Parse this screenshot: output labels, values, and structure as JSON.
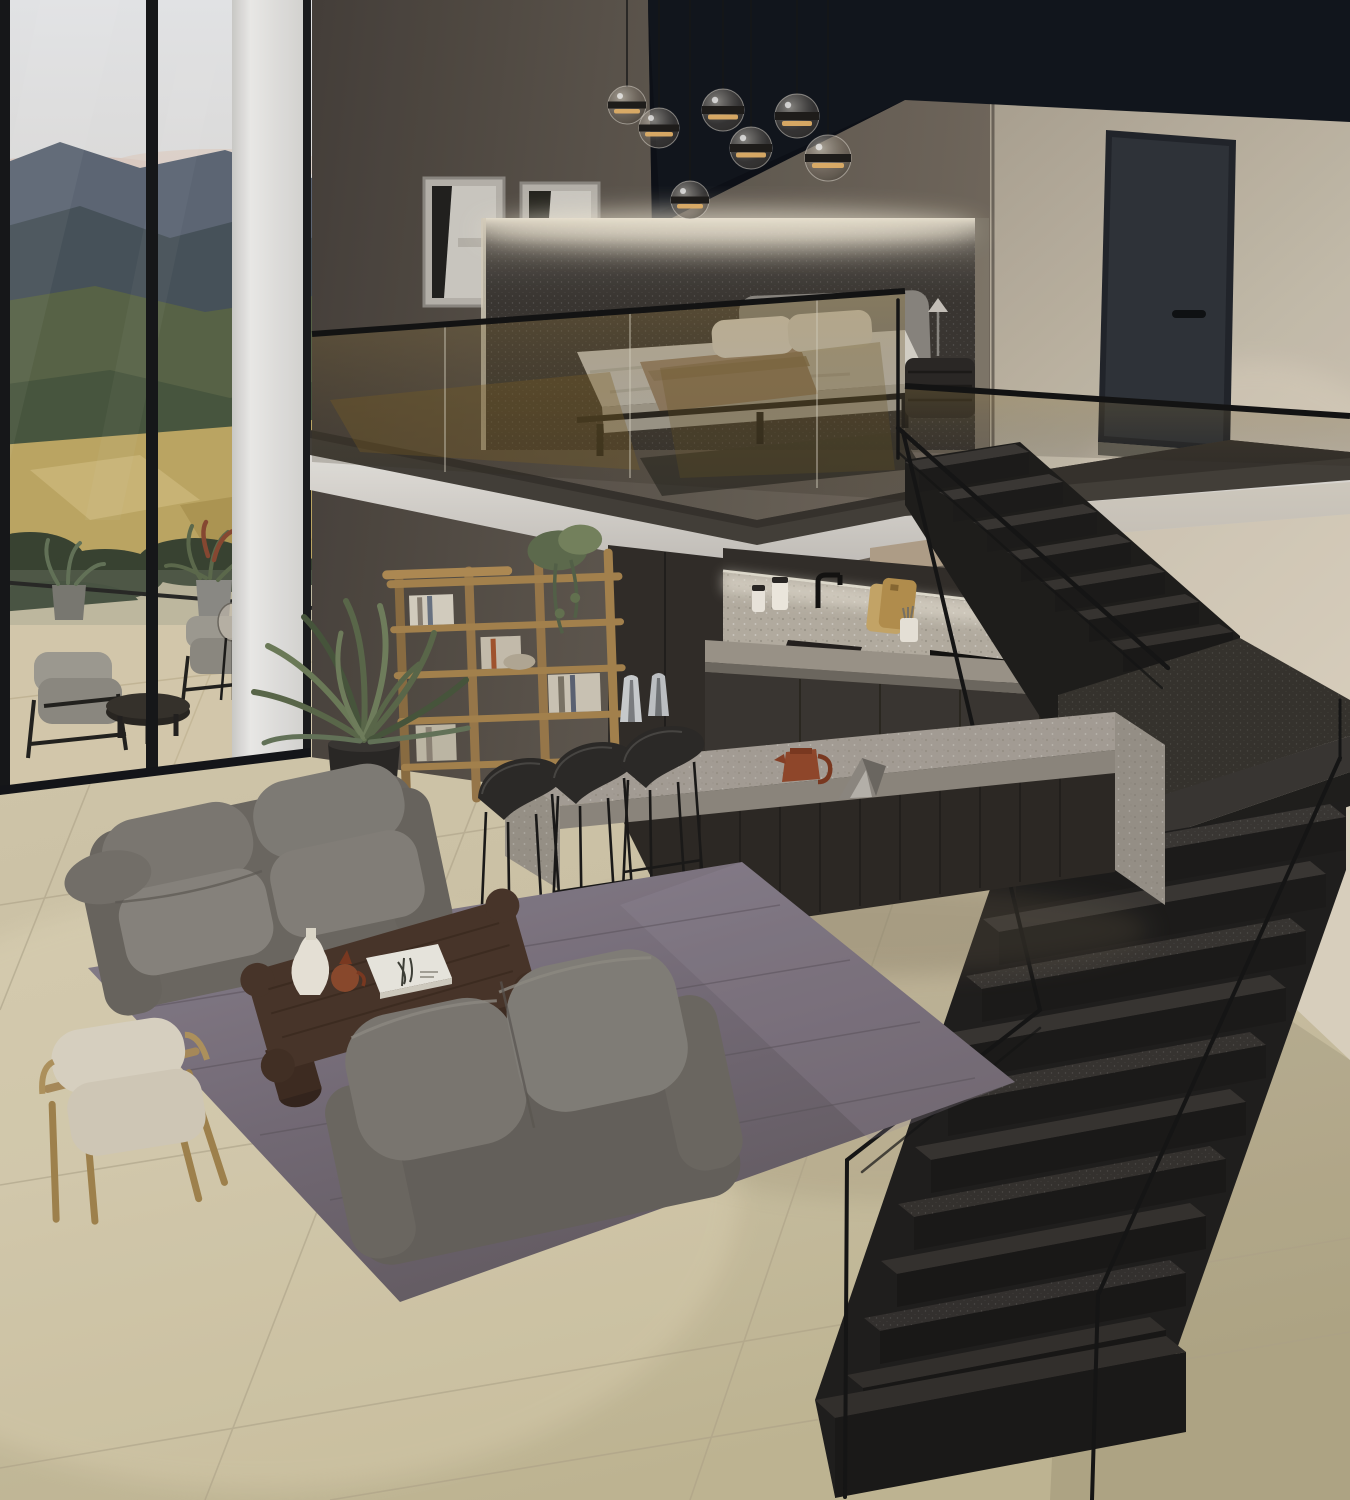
{
  "scene": {
    "title": "Double-height modern loft interior with mezzanine bedroom, open kitchen, lounge and black stone staircase overlooking mountains",
    "render_style": "photorealistic 3D architectural visualization",
    "setting": "daytime, mountain valley view through floor-to-ceiling glazing"
  },
  "palette": {
    "sky": "#e0e1e3",
    "mountains_far": "#5f6977",
    "hills_green": "#55604a",
    "fields_gold": "#c0aa66",
    "wall_taupe": "#57504a",
    "wall_cream": "#c7beac",
    "ceiling_recess_black": "#12161d",
    "slab_edge_white": "#dbd8d3",
    "stair_stone_black": "#2e2c29",
    "kitchen_cabinet_dark": "#37322e",
    "backsplash_terrazzo": "#b7b0a4",
    "island_terrazzo": "#a49d93",
    "floor_tile_beige": "#cfc5a8",
    "rug_grey_mauve": "#7c7380",
    "sofa_grey": "#75716b",
    "coffee_table_wood": "#4a362b",
    "accent_chair_cream": "#dcd4c2",
    "accent_chair_oak": "#ab8d5c",
    "bookshelf_oak": "#9b7a4c",
    "plant_green": "#5e6c4e",
    "bed_linen": "#d8d4cb",
    "bed_throw_tan": "#a78e73",
    "door_charcoal": "#30343a",
    "railing_black": "#161616",
    "pendant_glass_smoke": "#8a8378",
    "pendant_glow_warm": "#e5b36a"
  },
  "window_wall": {
    "label": "floor-to-ceiling window wall with mountain landscape",
    "landscape_layers": [
      "pale sky with soft clouds",
      "distant blue-grey mountains",
      "forested green hills",
      "sunlit golden fields",
      "dark pine treeline"
    ],
    "terrace_items": [
      "outdoor lounge chair",
      "outdoor lounge chair",
      "round black coffee table",
      "glass dome floor lamp",
      "potted terrace plants",
      "glass terrace balustrade"
    ]
  },
  "mezzanine": {
    "label": "mezzanine bedroom above kitchen",
    "items": [
      "double bed with light bedding",
      "tan throw blanket",
      "two white pillows",
      "grey upholstered headboard",
      "backlit dark stone feature wall",
      "abstract framed artwork",
      "abstract framed artwork",
      "black bedside cabinet with reading lamp",
      "dark bedside rug",
      "tinted glass balustrade with black handrail",
      "charcoal flush interior door",
      "black ceiling recess"
    ]
  },
  "kitchen": {
    "label": "open kitchen beneath mezzanine",
    "items": [
      "dark handleless tall cabinets",
      "terrazzo backsplash with under-cabinet lighting",
      "black faucet",
      "undermount sink",
      "black gas hob",
      "stacked black built-in ovens",
      "ceramic canisters",
      "wooden cutting boards",
      "utensil crock",
      "white bowl"
    ],
    "island_items": [
      "grey terrazzo waterfall island",
      "fluted dark wood island base",
      "black metal bar stool",
      "black metal bar stool",
      "black metal bar stool",
      "chrome carafes",
      "brown ceramic jug",
      "folded steel sculpture"
    ]
  },
  "living_area": {
    "label": "lounge on grey rug",
    "items": [
      "grey fabric three-seat sofa",
      "grey fabric two-seat sofa",
      "dark wood coffee table with cylinder legs",
      "white ceramic vase",
      "brown ceramic jug",
      "white art book",
      "cream armchair with oak frame",
      "large potted palm",
      "oak open bookshelf with books, bowl and trailing plant",
      "grey-mauve area rug",
      "beige stone tile floor"
    ]
  },
  "staircase": {
    "label": "black granite staircase with thin steel railings",
    "upper_flight_steps": 7,
    "lower_flight_steps": 10,
    "features": [
      "intermediate stone landing",
      "matte black handrails",
      "glass mezzanine guard"
    ]
  },
  "counts": {
    "pendant_lights": 7,
    "bar_stools": 3,
    "sofas": 2,
    "wall_frames": 2,
    "outdoor_chairs": 2
  }
}
